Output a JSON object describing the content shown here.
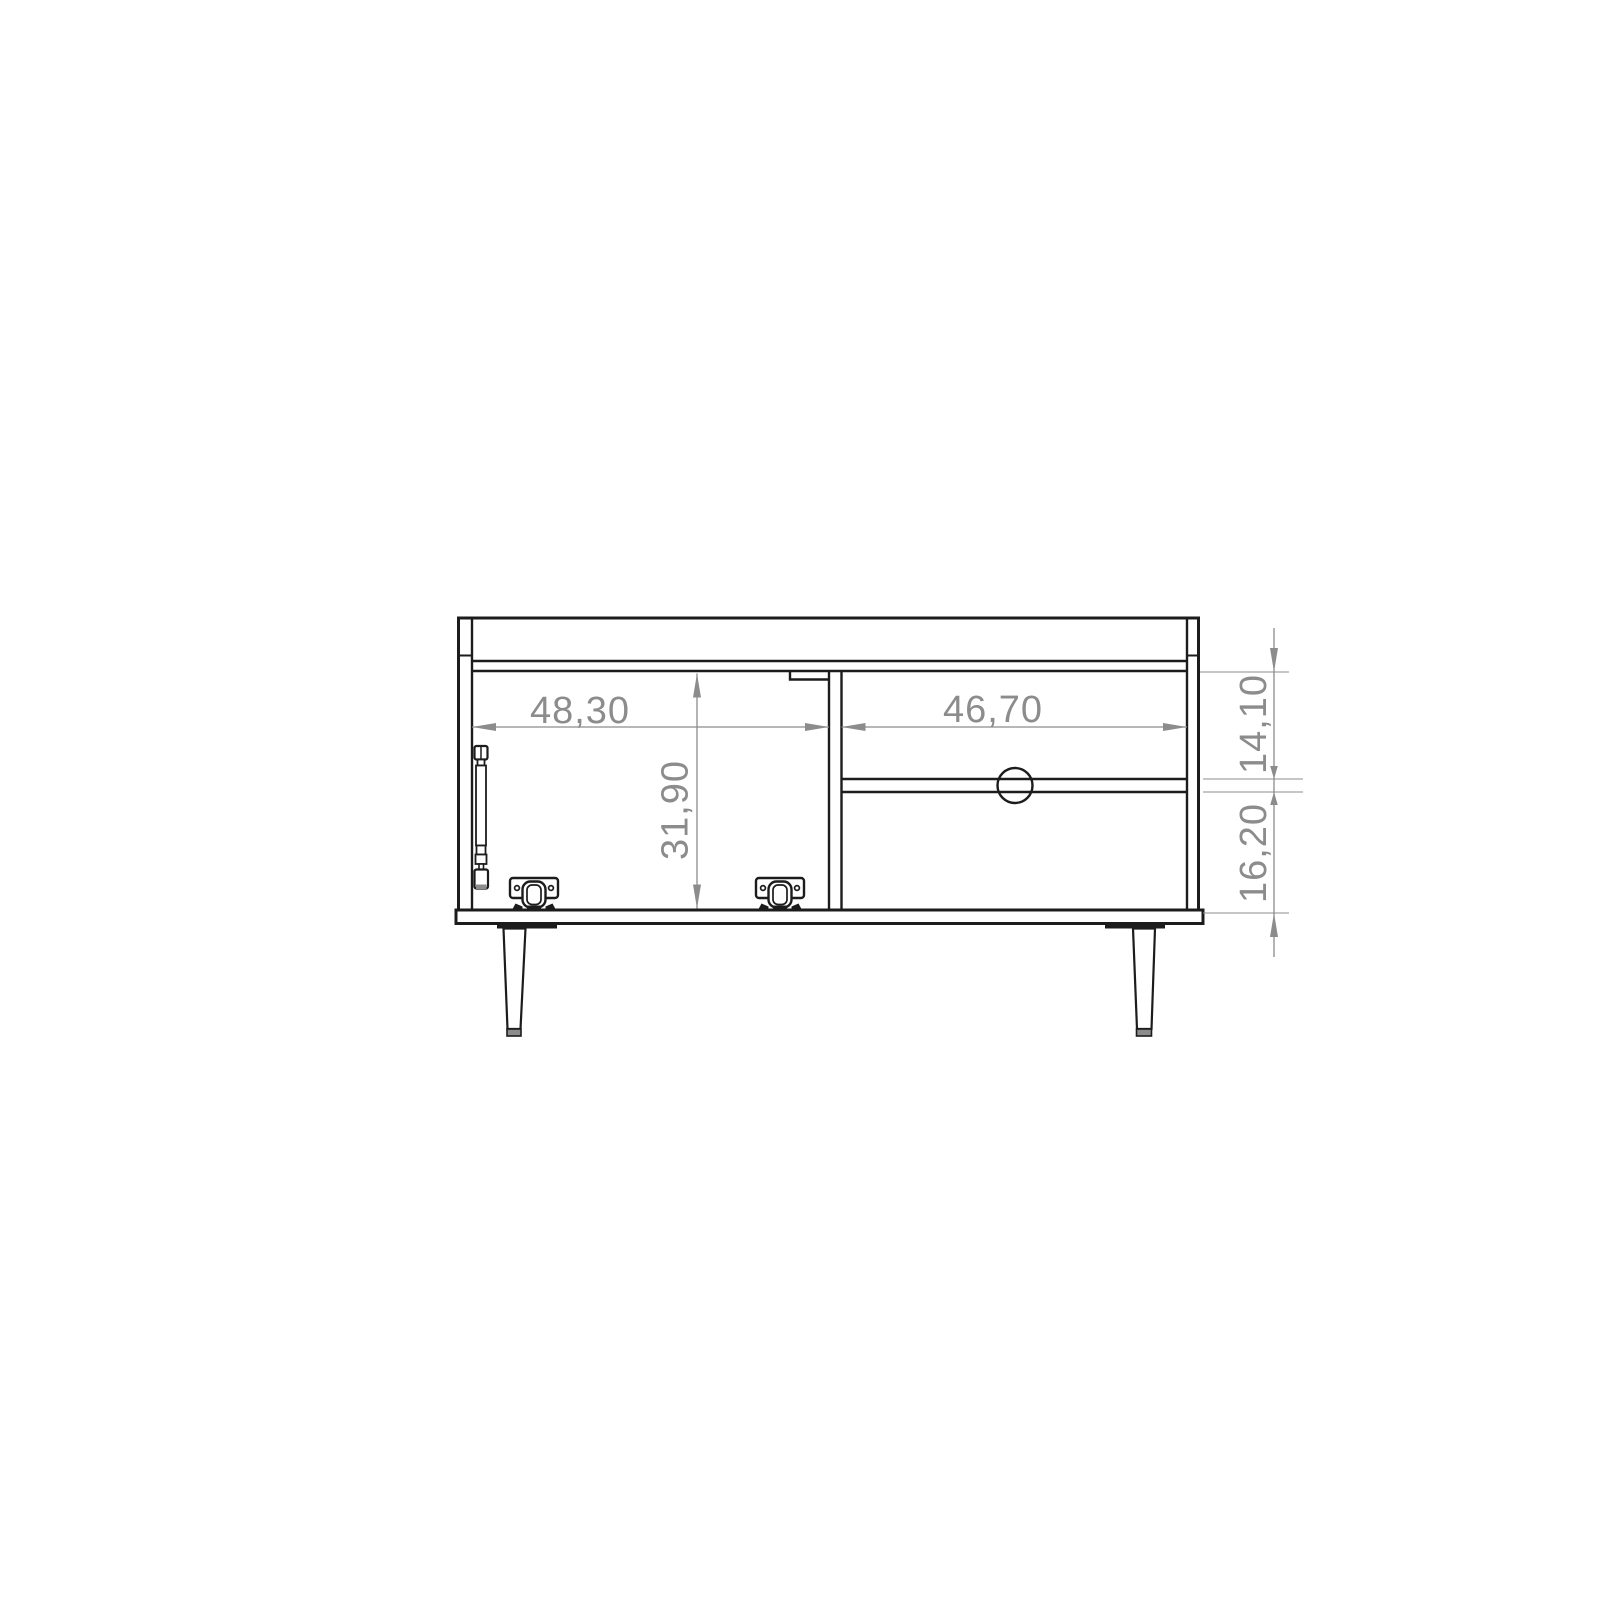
{
  "drawing": {
    "type": "furniture-technical-drawing-front-section",
    "dim_labels": {
      "left_width": "48,30",
      "right_width": "46,70",
      "left_height": "31,90",
      "right_upper_height": "14,10",
      "right_lower_height": "16,20"
    },
    "colors": {
      "background": "#ffffff",
      "line": "#1c1c1c",
      "dimension": "#8c8c8c",
      "foot_shade": "#8c8c8c"
    }
  }
}
